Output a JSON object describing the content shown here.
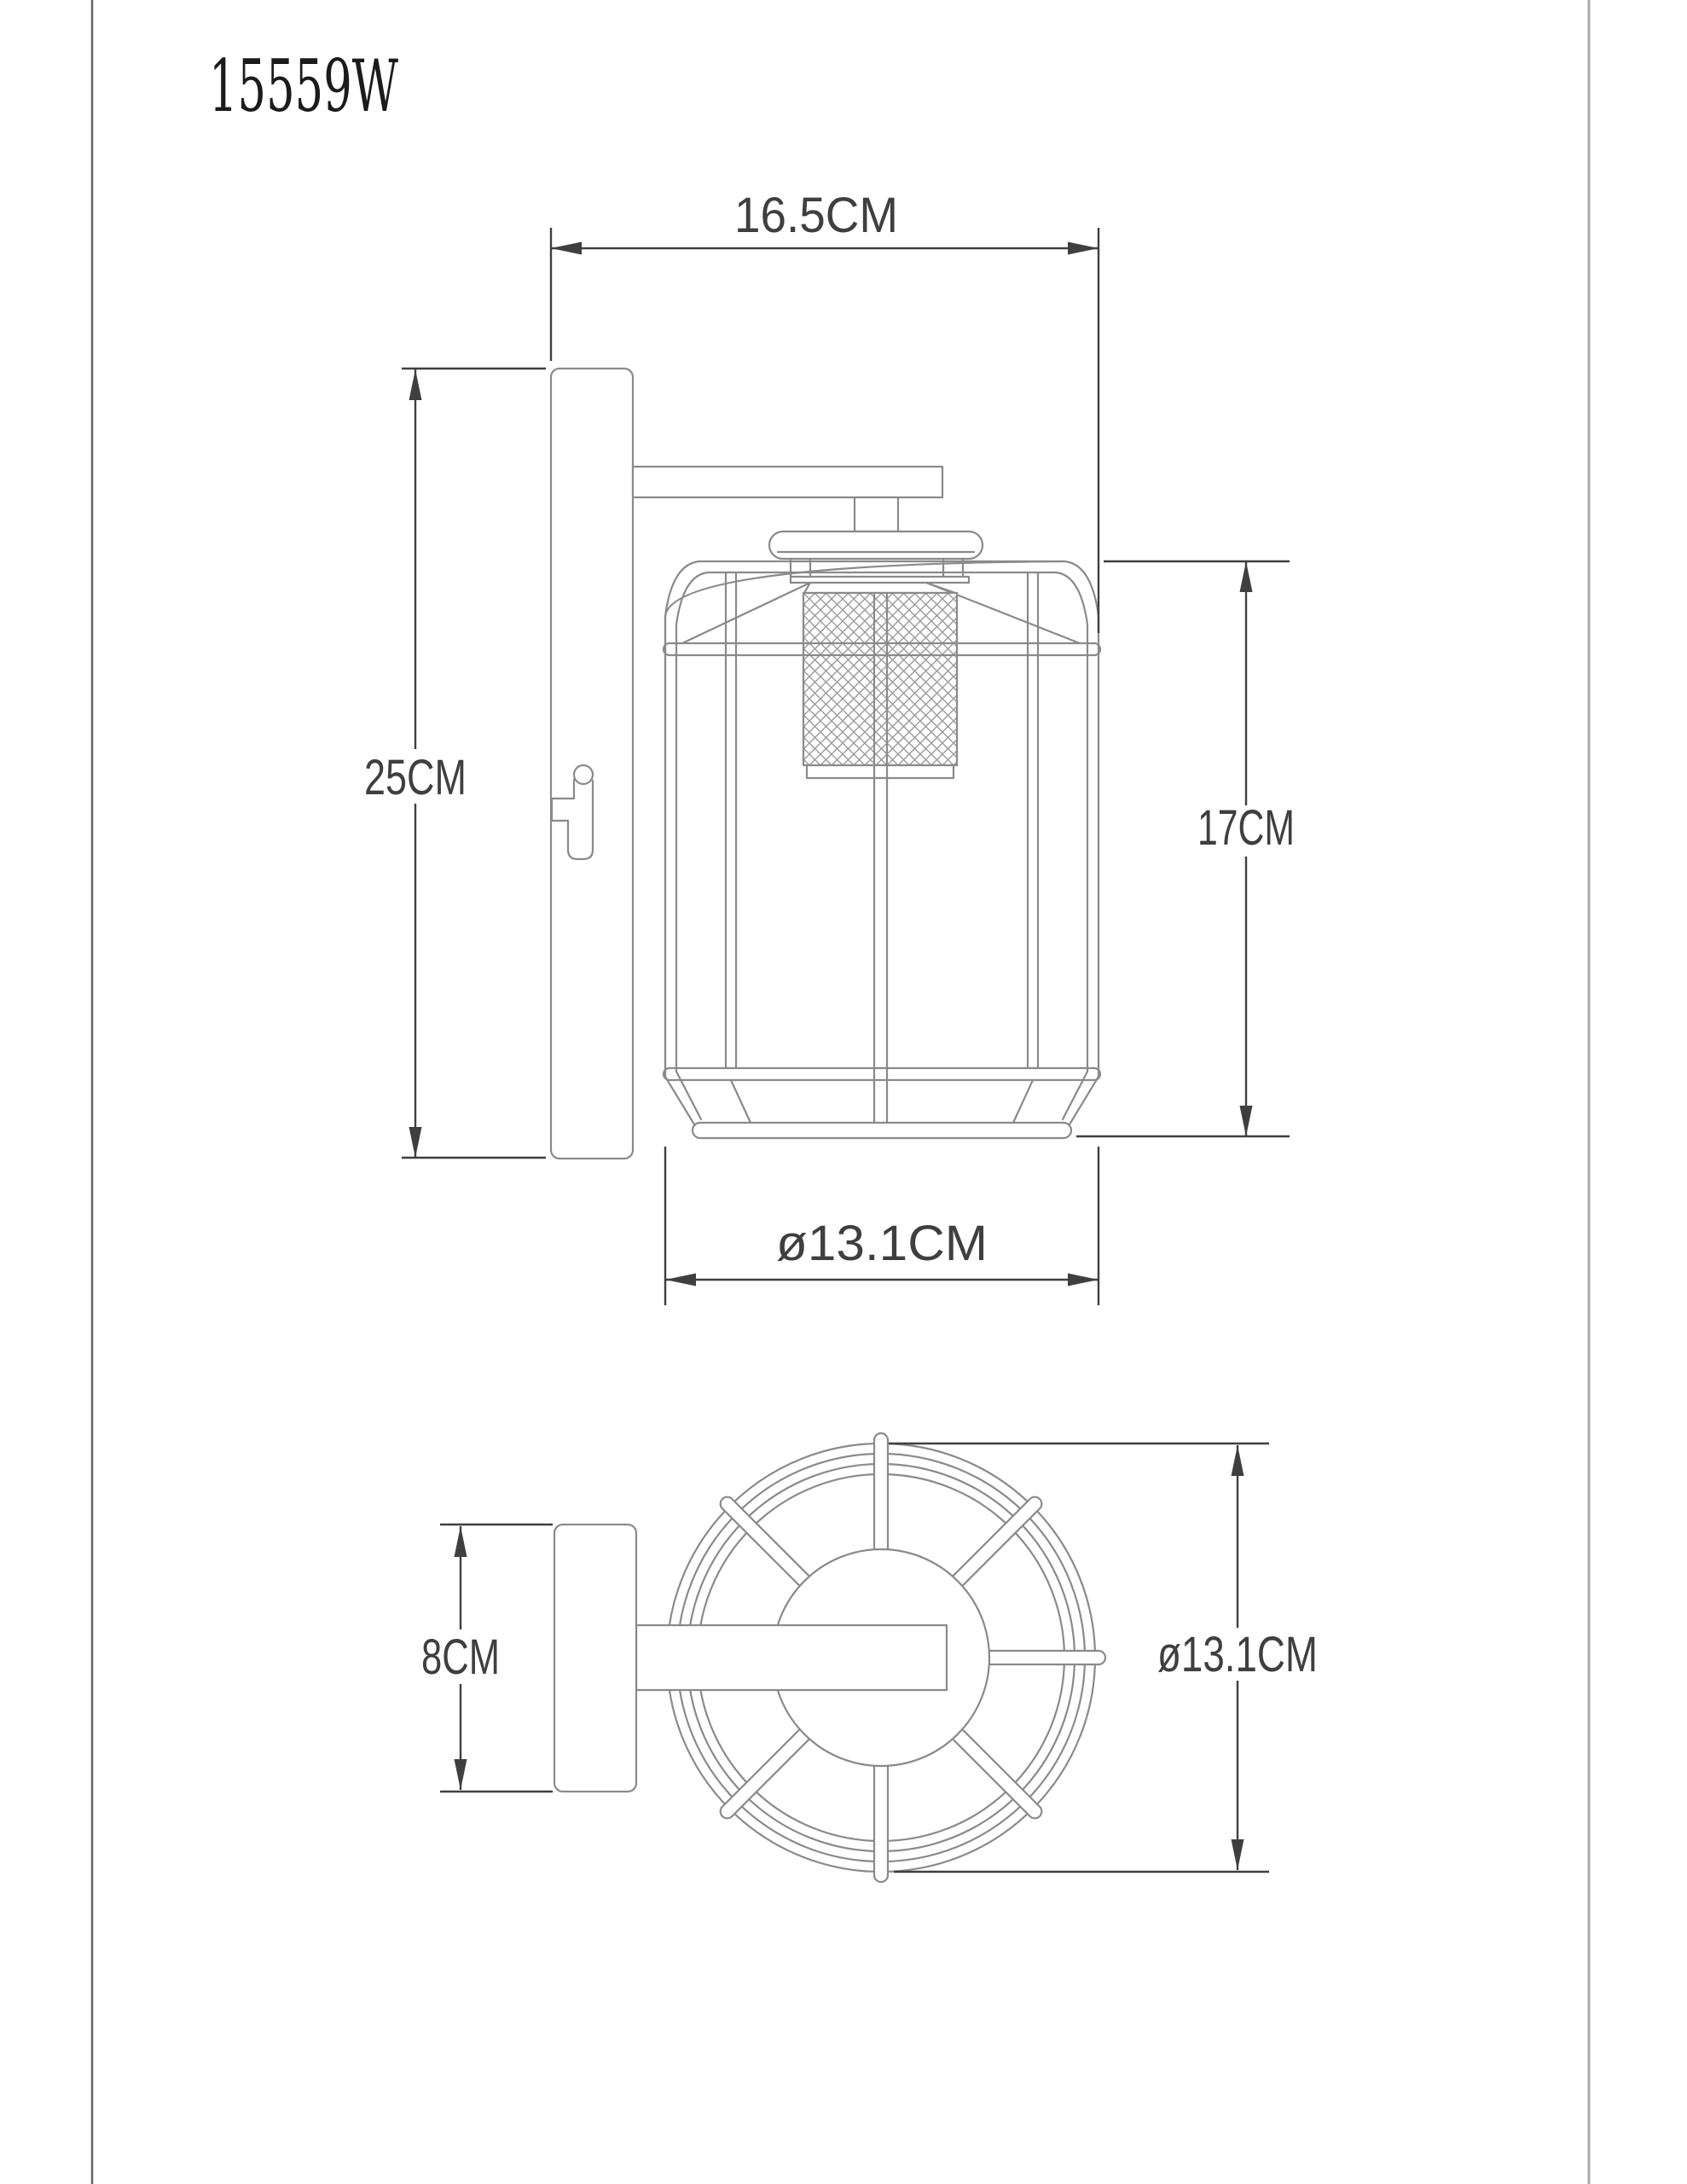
{
  "title": "15559W",
  "colors": {
    "background": "#ffffff",
    "linework": "#8a8a8a",
    "dimension_lines": "#3f3f3f",
    "title_text": "#1b1b1b",
    "border_left": "#666666",
    "border_right": "#a9a9a9"
  },
  "side_view": {
    "dimensions": {
      "total_depth": "16.5CM",
      "backplate_height": "25CM",
      "cage_height": "17CM",
      "cage_diameter": "ø13.1CM"
    }
  },
  "top_view": {
    "dimensions": {
      "backplate_width": "8CM",
      "cage_diameter": "ø13.1CM"
    }
  }
}
